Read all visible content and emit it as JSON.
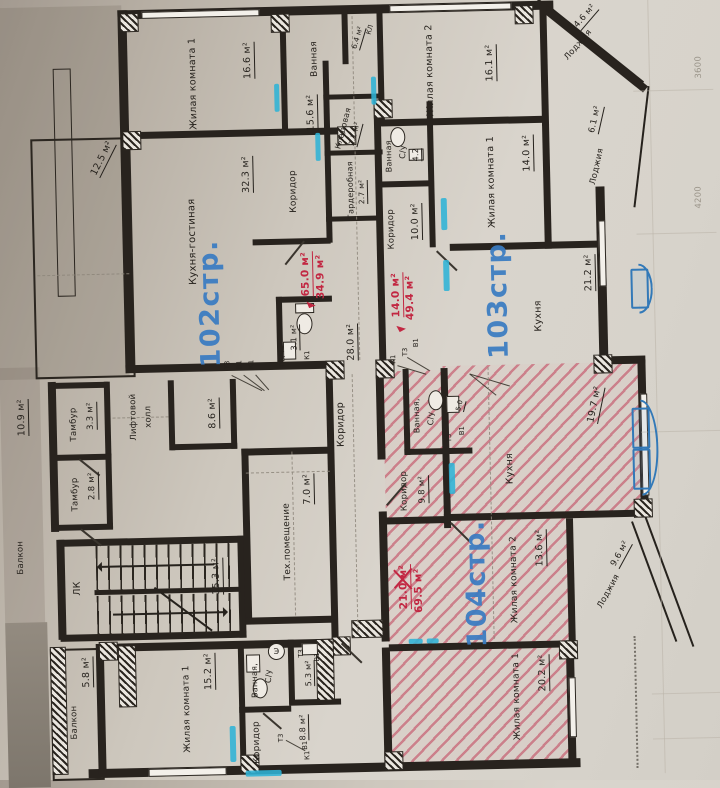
{
  "title": "Поэтажный план (фрагмент): квартиры 102стр., 103стр., 104стр.",
  "apartments": [
    {
      "label": "102стр.",
      "note": [
        "65.0 м²",
        "34.9 м²"
      ]
    },
    {
      "label": "103стр.",
      "note": [
        "14.0 м²",
        "49.4 м²"
      ]
    },
    {
      "label": "104стр.",
      "note": [
        "21.0 м²",
        "69.5 м²"
      ]
    }
  ],
  "rooms": {
    "top_living1": {
      "name": "Жилая комната 1",
      "area": "16.6 м²"
    },
    "top_bath": {
      "name": "Ванная",
      "area": "15.6 м²"
    },
    "top_storage": {
      "name": "КЛ",
      "area": "6.4 м²"
    },
    "top_living2": {
      "name": "Жилая комната 2",
      "area": "16.1 м²"
    },
    "top_loggia": {
      "name": "Лоджия",
      "area": "4.6 м²"
    },
    "left_balcony": {
      "area": "12.5 м²"
    },
    "kitchen_living": {
      "name": "Кухня-гостиная",
      "area": "32.3 м²"
    },
    "corridor102": {
      "name": "Коридор"
    },
    "kladovaya": {
      "name": "Кладовая",
      "area": "2.1 м²"
    },
    "garderobnaya": {
      "name": "Гардеробная",
      "area": "2.7 м²"
    },
    "bath103": {
      "name": "Ванная",
      "name2": "С/у",
      "area": "4.2"
    },
    "living103": {
      "name": "Жилая комната 1",
      "area": "14.0 м²"
    },
    "corridor103": {
      "name": "Коридор",
      "area": "10.0 м²"
    },
    "loggia_right": {
      "name": "Лоджия",
      "area": "6.1 м²"
    },
    "kitchen103": {
      "name": "Кухня",
      "area": "21.2 м²"
    },
    "bath102": {
      "area": "3.1 м²",
      "note": "ПБ/ч"
    },
    "hall28": {
      "area": "28.0 м²"
    },
    "corridor_common": {
      "name": "Коридор"
    },
    "tambur1": {
      "name": "Тамбур",
      "area": "3.3 м²"
    },
    "balcony_left": {
      "name": "Балкон",
      "area": "10.9 м²"
    },
    "lift_hall": {
      "name": "Лифтовой",
      "name2": "холл"
    },
    "room86": {
      "area": "8.6 м²"
    },
    "tambur2": {
      "name": "Тамбур",
      "area": "2.8 м²"
    },
    "stairs": {
      "name": "ЛК",
      "area": "15.3 м²"
    },
    "tech": {
      "name": "Тех.помещение",
      "area": "7.0 м²"
    },
    "bath104": {
      "name": "Ванная,",
      "name2": "С/у",
      "area": "5.0"
    },
    "corridor104": {
      "name": "Коридор",
      "area": "9.8 м²"
    },
    "kitchen104": {
      "name": "Кухня",
      "area": "19.7 м²"
    },
    "living104_2": {
      "name": "Жилая комната 2",
      "area": "13.6 м²"
    },
    "living104_1": {
      "name": "Жилая комната 1",
      "area": "20.2 м²"
    },
    "loggia_br": {
      "name": "Лоджия",
      "area": "9.6 м²"
    },
    "balcony_bottom": {
      "name": "Балкон",
      "area": "5.8 м²"
    },
    "living_bottom": {
      "name": "Жилая комната 1",
      "area": "15.2 м²"
    },
    "bath_bottom": {
      "name": "Ванная,",
      "name2": "С/у",
      "area": "5.3 м²"
    },
    "corridor_bottom": {
      "name": "Коридор",
      "area": "8.8 м²"
    }
  },
  "markers": {
    "t3": "Т3",
    "v1": "В1",
    "k1": "К1",
    "stove": "Э"
  },
  "margin": {
    "dims": [
      "3600",
      "4200"
    ]
  }
}
